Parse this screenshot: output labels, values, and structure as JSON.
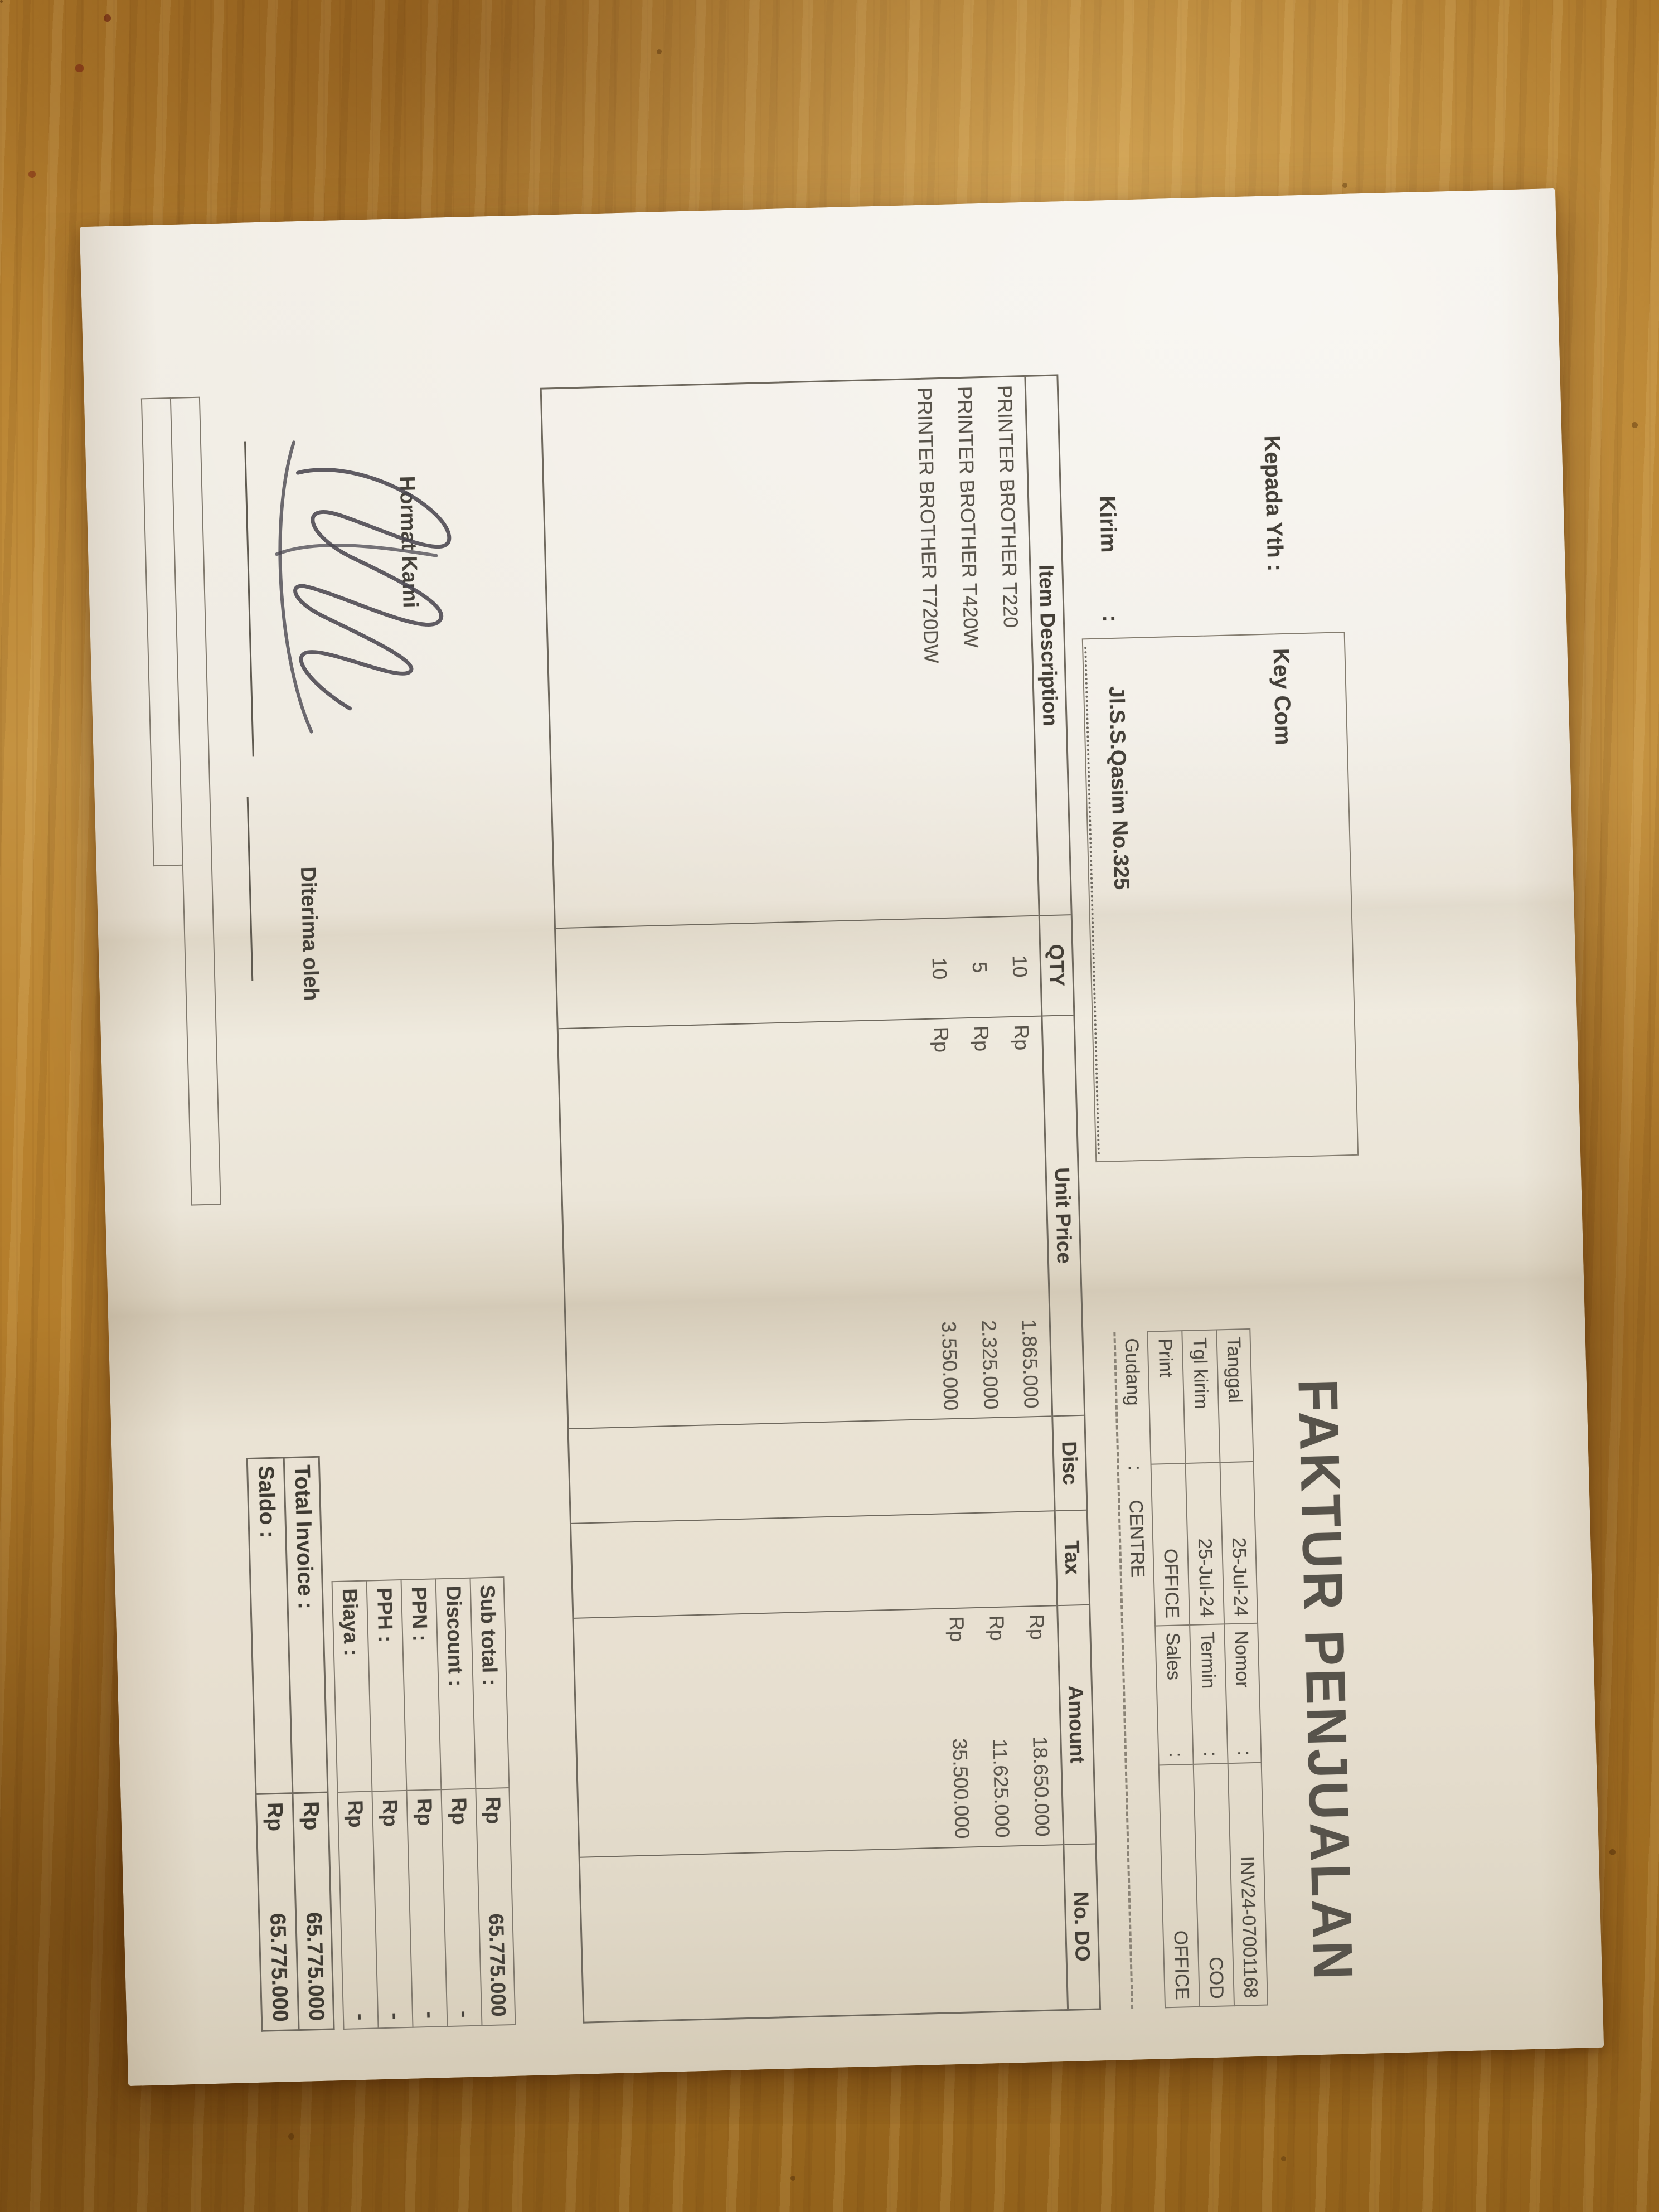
{
  "document": {
    "title": "FAKTUR PENJUALAN",
    "kepada_label": "Kepada Yth :",
    "customer": "Key Com",
    "kirim_label": "Kirim",
    "kirim_colon": ":",
    "address": "Jl.S.S.Qasim No.325",
    "info": {
      "colon": ":",
      "rows": [
        [
          "Tanggal",
          "25-Jul-24",
          "Nomor",
          "INV24-07001168"
        ],
        [
          "Tgl kirim",
          "25-Jul-24",
          "Termin",
          "COD"
        ],
        [
          "Print",
          "OFFICE",
          "Sales",
          "OFFICE"
        ]
      ],
      "gudang_label": "Gudang",
      "gudang_value": "CENTRE"
    },
    "table": {
      "headers": [
        "Item Description",
        "QTY",
        "Unit Price",
        "Disc",
        "Tax",
        "Amount",
        "No. DO"
      ],
      "currency": "Rp",
      "rows": [
        {
          "desc": "PRINTER BROTHER T220",
          "qty": "10",
          "unit_price": "1.865.000",
          "amount": "18.650.000"
        },
        {
          "desc": "PRINTER BROTHER T420W",
          "qty": "5",
          "unit_price": "2.325.000",
          "amount": "11.625.000"
        },
        {
          "desc": "PRINTER BROTHER T720DW",
          "qty": "10",
          "unit_price": "3.550.000",
          "amount": "35.500.000"
        }
      ]
    },
    "totals": {
      "currency": "Rp",
      "rows": [
        {
          "label": "Sub total :",
          "value": "65.775.000"
        },
        {
          "label": "Discount :",
          "value": "-"
        },
        {
          "label": "PPN   :",
          "value": "-"
        },
        {
          "label": "PPH   :",
          "value": "-"
        },
        {
          "label": "Biaya   :",
          "value": "-"
        }
      ],
      "grand": [
        {
          "label": "Total Invoice :",
          "value": "65.775.000"
        },
        {
          "label": "Saldo   :",
          "value": "65.775.000"
        }
      ]
    },
    "signature": {
      "left_label": "Hormat Kami",
      "right_label": "Diterima oleh"
    }
  },
  "colors": {
    "wood": "#b07a2a",
    "paper": "#efeade",
    "ink": "#4e4a42",
    "table_line": "#80796d",
    "pen": "#4a4750"
  }
}
